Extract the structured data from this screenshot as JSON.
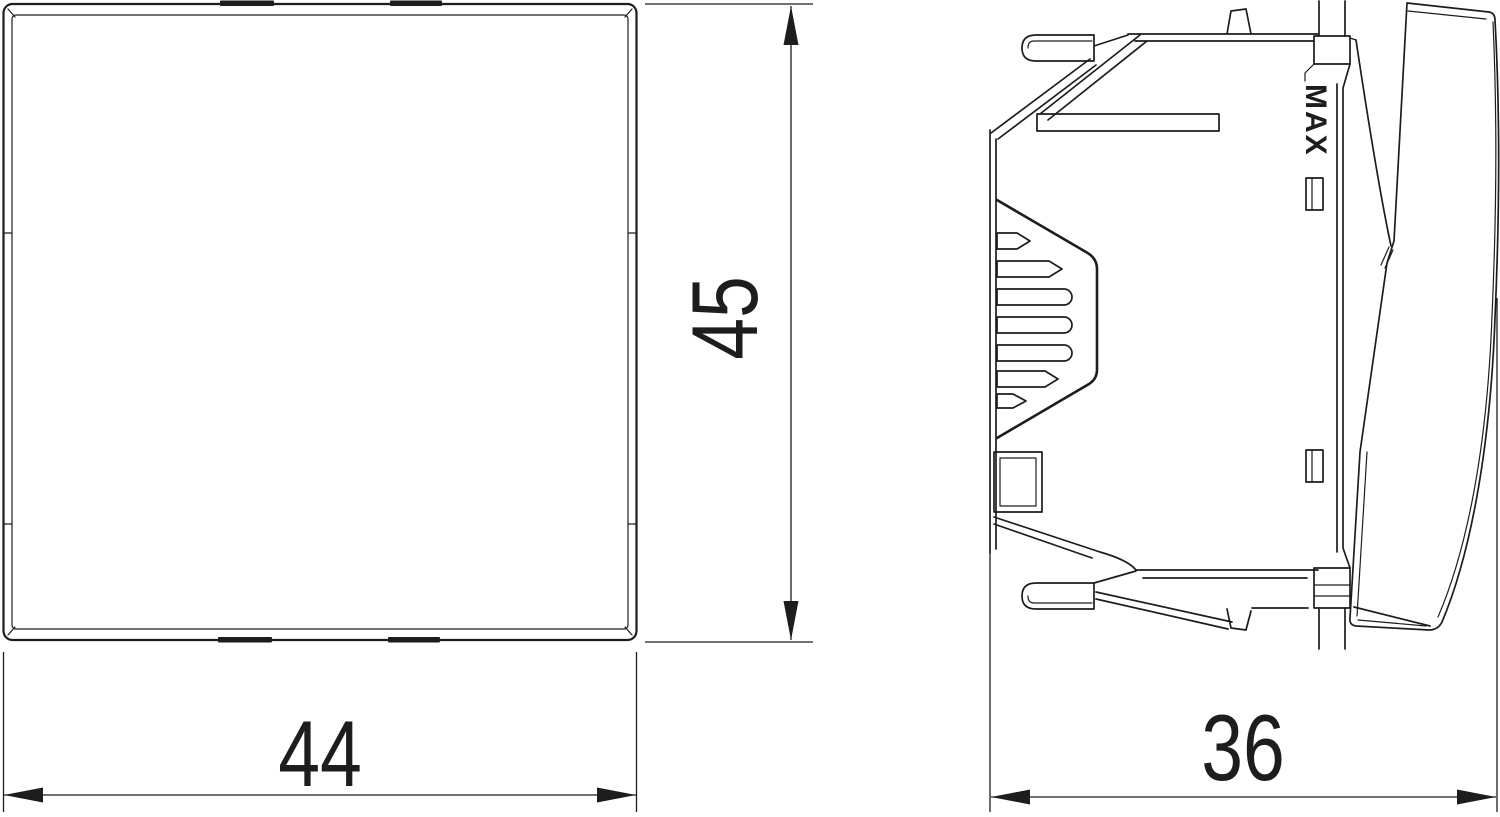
{
  "colors": {
    "line": "#1d1d1b",
    "background": "#ffffff"
  },
  "dimensions": {
    "front_width_mm": "44",
    "front_height_mm": "45",
    "side_depth_mm": "36"
  },
  "markings": {
    "max_label": "MAX"
  }
}
